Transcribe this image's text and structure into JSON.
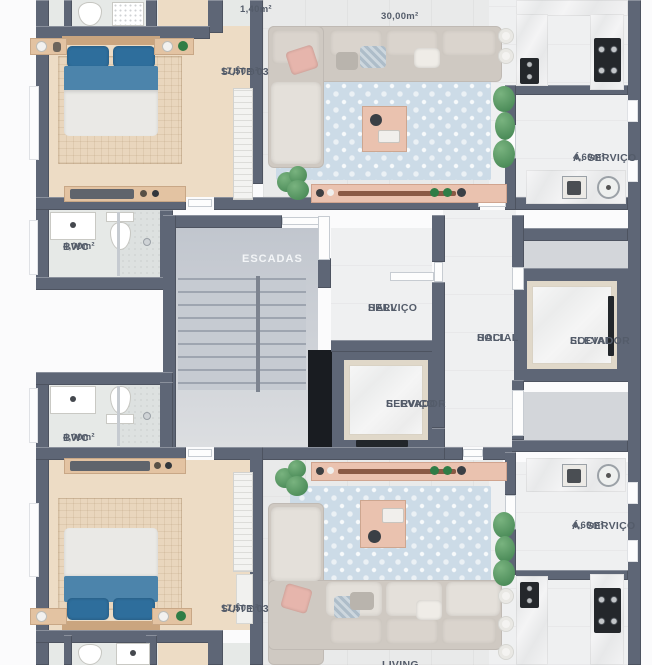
{
  "title": "Planta baixa - pavimento tipo",
  "colors": {
    "wall": "#5e6676",
    "floor_bedroom": "#eddcc5",
    "rug_bedroom": "#e9d6bd",
    "floor_living": "#e9eaea",
    "rug_living": "#ccdbe7",
    "floor_white": "#eff0f1",
    "floor_buffer": "#d3d6da",
    "wood_light": "#e3c3a2",
    "wood_pink": "#eac2af",
    "sofa": "#cfc9c2",
    "sofa_cushion": "#dad4cd",
    "bed_white": "#eae9e6",
    "bed_blue": "#4c84ab",
    "pillow_blue": "#2e6e9c",
    "plant": "#4c8c59",
    "stove": "#24272b",
    "shaft": "#191c21",
    "elevator_frame": "#e0d8c9",
    "label_text": "#545c6a",
    "label_white": "#f3f5f7"
  },
  "rooms": {
    "bath_top": {
      "area": "1,40m²"
    },
    "living_top": {
      "area": "30,00m²"
    },
    "suite_top": {
      "name": "SUÍTE 03",
      "area": "17,50m²"
    },
    "servico_top": {
      "name": "Á. SERVIÇO",
      "area": "4,60m²"
    },
    "bwc_top": {
      "name": "BWC",
      "area": "4,00m²"
    },
    "escadas": {
      "name": "ESCADAS"
    },
    "hall_servico": {
      "line1": "HALL",
      "line2": "SERVIÇO"
    },
    "hall_social": {
      "line1": "HALL",
      "line2": "SOCIAL"
    },
    "elevador_servico": {
      "line1": "ELEVADOR",
      "line2": "SERVIÇO"
    },
    "elevador_social": {
      "line1": "ELEVADOR",
      "line2": "SOCIAL"
    },
    "bwc_bottom": {
      "name": "BWC",
      "area": "4,00m²"
    },
    "suite_bottom": {
      "name": "SUÍTE 03",
      "area": "17,50m²"
    },
    "servico_bottom": {
      "name": "Á. SERVIÇO",
      "area": "4,60m²"
    },
    "living_bottom": {
      "name": "LIVING"
    }
  }
}
